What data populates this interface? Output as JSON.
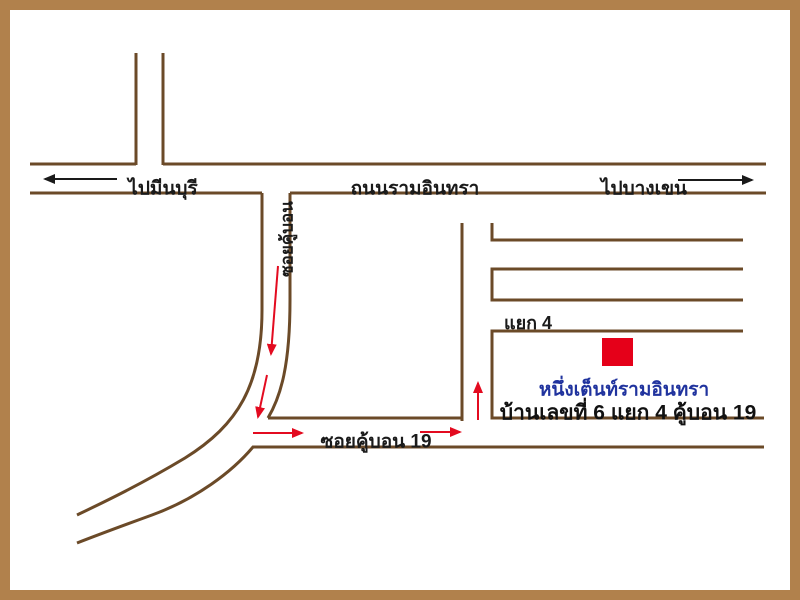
{
  "map": {
    "main_road": {
      "name": "ถนนรามอินทรา",
      "direction_left": "ไปมีนบุรี",
      "direction_right": "ไปบางเขน"
    },
    "soi_vertical_label": "ซอยคู้บอน",
    "soi_label": "ซอยคู้บอน 19",
    "junction_label": "แยก 4",
    "destination": {
      "name": "หนึ่งเต็นท์รามอินทรา",
      "address": "บ้านเลขที่ 6 แยก 4 คู้บอน 19"
    },
    "colors": {
      "frame": "#b1814c",
      "road_line": "#6b4a28",
      "route_red": "#e30b20",
      "marker_red": "#e50019",
      "destination_blue": "#20339e",
      "text_black": "#1a1a1a",
      "background": "#ffffff"
    }
  }
}
